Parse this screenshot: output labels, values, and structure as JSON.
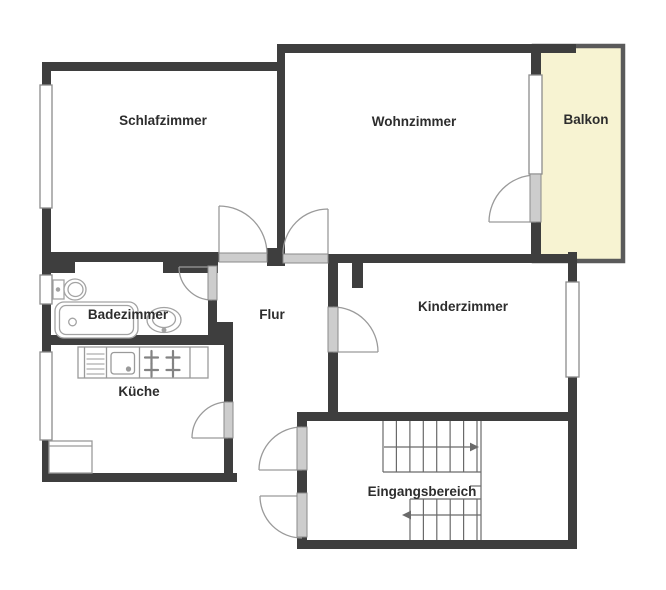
{
  "plan": {
    "type": "apartment-floor-plan",
    "rooms": {
      "schlafzimmer": {
        "label": "Schlafzimmer"
      },
      "wohnzimmer": {
        "label": "Wohnzimmer"
      },
      "balkon": {
        "label": "Balkon"
      },
      "badezimmer": {
        "label": "Badezimmer"
      },
      "flur": {
        "label": "Flur"
      },
      "kinderzimmer": {
        "label": "Kinderzimmer"
      },
      "kueche": {
        "label": "Küche"
      },
      "eingangsbereich": {
        "label": "Eingangsbereich"
      }
    },
    "fixtures": [
      "toilet",
      "bathtub",
      "washbasin",
      "kitchen-counter",
      "kitchen-sink",
      "dishwasher",
      "stove",
      "refrigerator",
      "staircase"
    ],
    "stairs": {
      "upper_flight_arrow": "right",
      "lower_flight_arrow": "left"
    }
  },
  "colors": {
    "wall": "#3e3e3e",
    "balcony_fill": "#f7f3d2",
    "balcony_border": "#5a5a5a",
    "door_leaf": "#cdcdcd",
    "door_leaf_border": "#8a8a8a",
    "symbol_line": "#9a9a9a",
    "window_fill": "#ffffff",
    "window_border": "#8c8c8c",
    "stair_line": "#6a6a6a",
    "fixture_line": "#a3a3a3",
    "text": "#2d2d2d",
    "background": "#ffffff"
  }
}
